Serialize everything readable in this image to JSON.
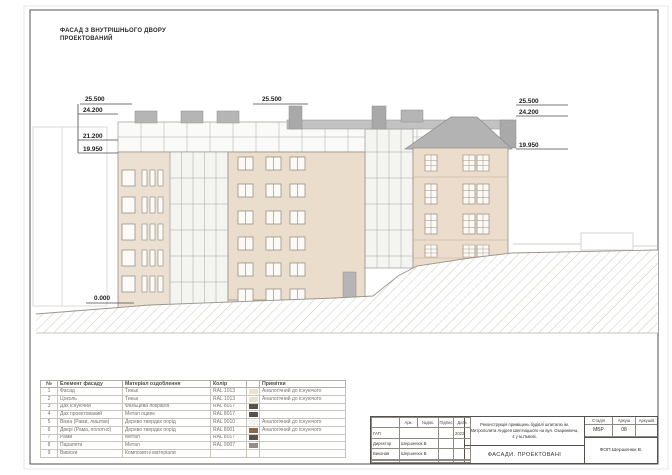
{
  "sheet": {
    "title_line1": "ФАСАД З ВНУТРІШНЬОГО ДВОРУ",
    "title_line2": "ПРОЕКТОВАНИЙ"
  },
  "marks": {
    "left1": "25.500",
    "left2": "24.200",
    "left3": "21.200",
    "left4": "19.950",
    "mid": "25.500",
    "right1": "25.500",
    "right2": "24.200",
    "right3": "19.950",
    "zero": "0.000"
  },
  "materials_table": {
    "headers": {
      "num": "№",
      "element": "Елемент фасаду",
      "material": "Матеріал оздоблення",
      "color": "Колір",
      "notes": "Примітки"
    },
    "rows": [
      {
        "num": "1",
        "element": "Фасад",
        "material": "Тиньк",
        "color": "RAL 1013",
        "swatch": "#e9e2cd",
        "notes": "Аналогічний до існуючого"
      },
      {
        "num": "2",
        "element": "Цоколь",
        "material": "Тиньк",
        "color": "RAL 1013",
        "swatch": "#e9e2cd",
        "notes": "Аналогічний до існуючого"
      },
      {
        "num": "3",
        "element": "Дах існуючий",
        "material": "Фальцева покрівля",
        "color": "RAL 8017",
        "swatch": "#57524d",
        "notes": ""
      },
      {
        "num": "4",
        "element": "Дах проектований",
        "material": "Метал оцинк.",
        "color": "RAL 8017",
        "swatch": "#57524d",
        "notes": ""
      },
      {
        "num": "5",
        "element": "Вікна (Рами, лиштви)",
        "material": "Дерево твердих порід",
        "color": "RAL 9010",
        "swatch": "#f4f2ec",
        "notes": "Аналогічний до існуючого"
      },
      {
        "num": "6",
        "element": "Двері (Рама, полотно)",
        "material": "Дерево твердих порід",
        "color": "RAL 8001",
        "swatch": "#8a6844",
        "notes": "Аналогічний до існуючого"
      },
      {
        "num": "7",
        "element": "Рами",
        "material": "Метал",
        "color": "RAL 8017",
        "swatch": "#57524d",
        "notes": ""
      },
      {
        "num": "8",
        "element": "Парапети",
        "material": "Метал",
        "color": "RAL 9007",
        "swatch": "#8f8f8c",
        "notes": ""
      },
      {
        "num": "9",
        "element": "Вивіски",
        "material": "Композитні матеріали",
        "color": "",
        "swatch": "",
        "notes": ""
      }
    ]
  },
  "title_block": {
    "col_arc": "Арк.",
    "col_doc": "№док.",
    "col_sign": "Підпис",
    "col_date": "Дата",
    "rows": [
      {
        "role": "ГАП",
        "name": "",
        "date": "2022"
      },
      {
        "role": "Директор",
        "name": "Шершенюк В.",
        "date": ""
      },
      {
        "role": "Виконав",
        "name": "Шершенюк В.",
        "date": ""
      }
    ],
    "project": "Реконструкція приміщень будівлі шпиталю ім. Митрополита Андрея Шептицького на вул. Озаркевича, 4 у м.Львові.",
    "stage_label": "Стадія",
    "sheet_label": "Аркуш",
    "sheets_label": "Аркушів",
    "stage": "МБР",
    "sheet_no": "08",
    "sheets_total": "",
    "drawing_title": "ФАСАДИ. ПРОЕКТОВАНІ",
    "company": "ФОП Шершенюк В."
  }
}
